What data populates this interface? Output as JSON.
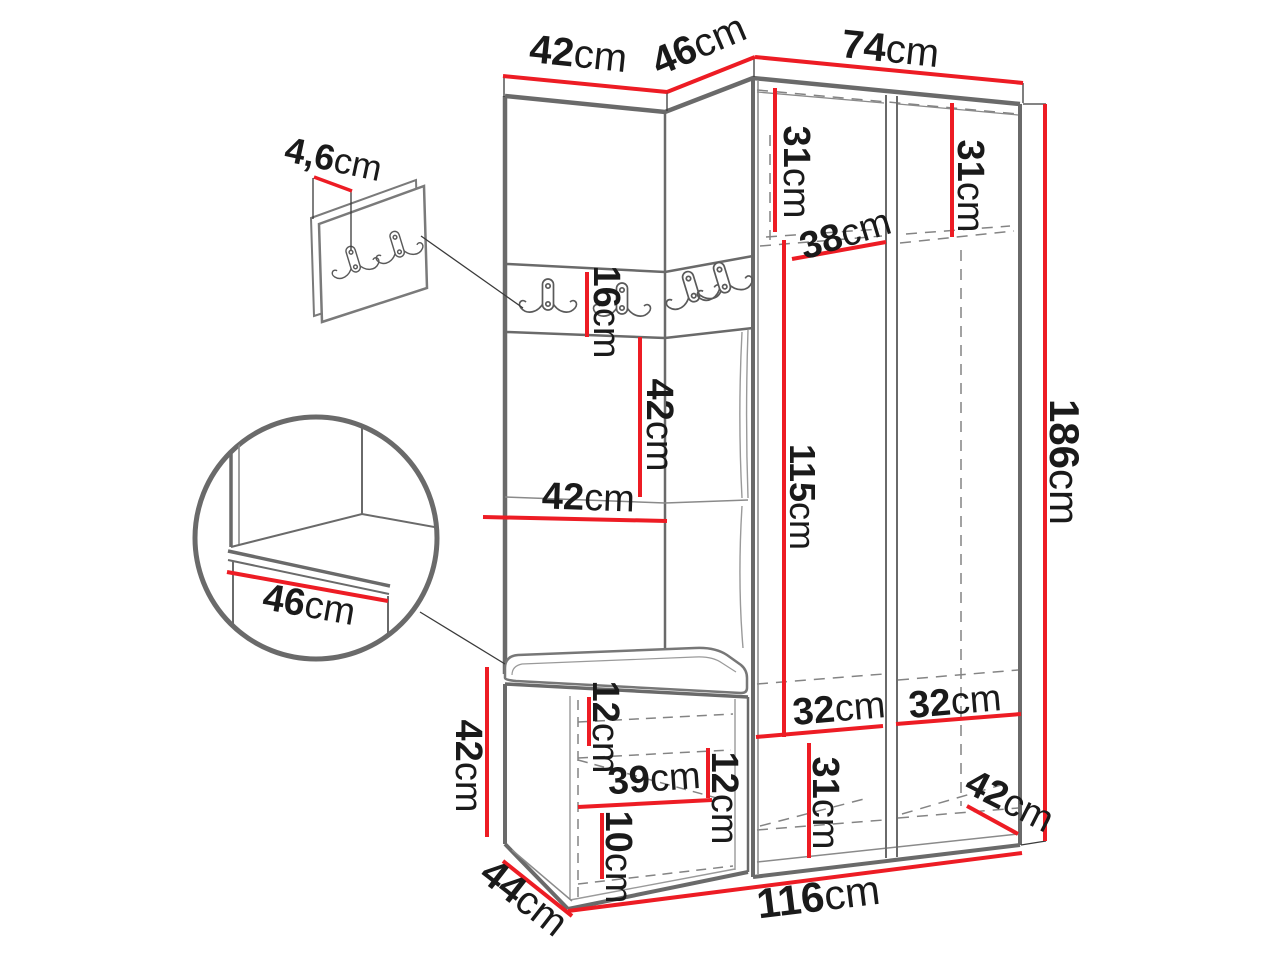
{
  "diagram": {
    "unit": "cm",
    "colors": {
      "dimension_line": "#ed1c24",
      "outline": "#6a6a6a",
      "text": "#1a1a1a"
    },
    "dims": {
      "top_width_left": {
        "value": "42",
        "unit": "cm"
      },
      "top_width_corner": {
        "value": "46",
        "unit": "cm"
      },
      "top_width_right": {
        "value": "74",
        "unit": "cm"
      },
      "hook_panel_thickness": {
        "value": "4,6",
        "unit": "cm"
      },
      "upper_shelf_left_height": {
        "value": "31",
        "unit": "cm"
      },
      "upper_shelf_right_height": {
        "value": "31",
        "unit": "cm"
      },
      "upper_shelf_depth": {
        "value": "38",
        "unit": "cm"
      },
      "hook_strip_height": {
        "value": "16",
        "unit": "cm"
      },
      "niche_upper_height": {
        "value": "42",
        "unit": "cm"
      },
      "niche_width": {
        "value": "42",
        "unit": "cm"
      },
      "door_section_height": {
        "value": "115",
        "unit": "cm"
      },
      "total_height": {
        "value": "186",
        "unit": "cm"
      },
      "seat_detail_depth": {
        "value": "46",
        "unit": "cm"
      },
      "bench_height": {
        "value": "42",
        "unit": "cm"
      },
      "bench_depth": {
        "value": "44",
        "unit": "cm"
      },
      "bench_inner_upper_height": {
        "value": "12",
        "unit": "cm"
      },
      "bench_inner_width": {
        "value": "39",
        "unit": "cm"
      },
      "bench_inner_right_height": {
        "value": "12",
        "unit": "cm"
      },
      "bench_inner_lower_height": {
        "value": "10",
        "unit": "cm"
      },
      "total_width": {
        "value": "116",
        "unit": "cm"
      },
      "lower_left_comp_width": {
        "value": "32",
        "unit": "cm"
      },
      "lower_right_comp_width": {
        "value": "32",
        "unit": "cm"
      },
      "lower_comp_height": {
        "value": "31",
        "unit": "cm"
      },
      "wardrobe_depth": {
        "value": "42",
        "unit": "cm"
      }
    }
  }
}
